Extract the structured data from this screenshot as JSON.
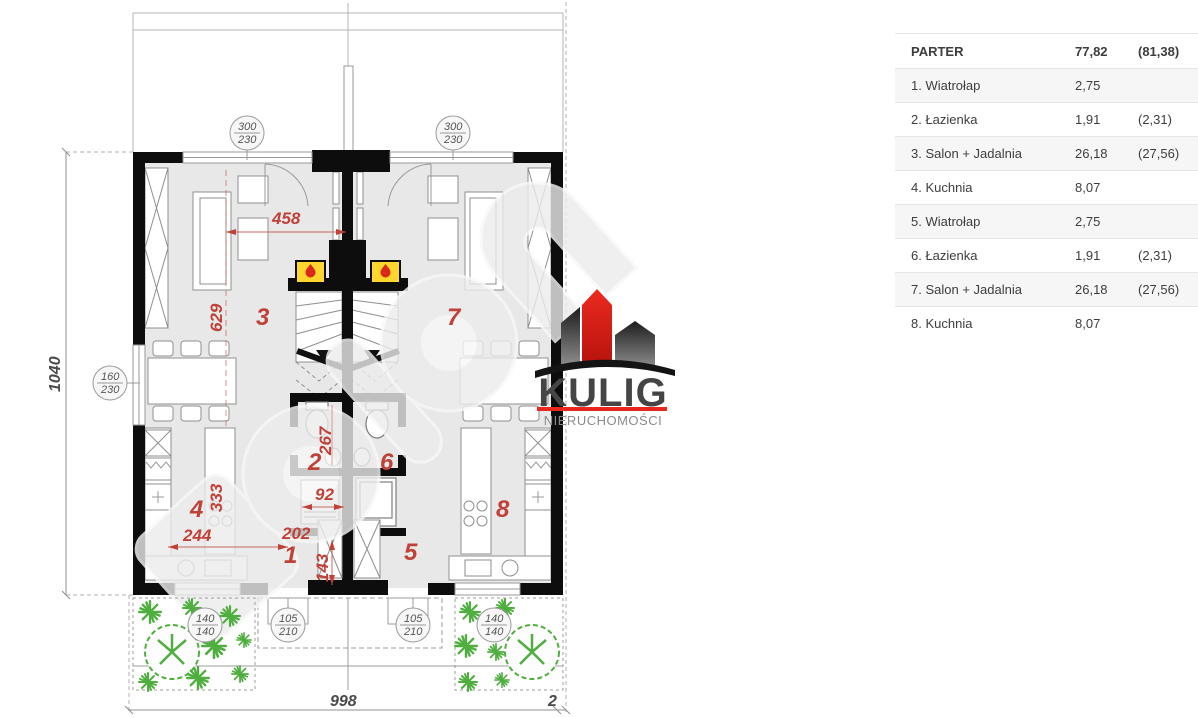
{
  "panel": {
    "header": {
      "label": "PARTER",
      "value": "77,82",
      "value_alt": "(81,38)"
    },
    "rows": [
      {
        "label": "1. Wiatrołap",
        "value": "2,75",
        "value_alt": ""
      },
      {
        "label": "2. Łazienka",
        "value": "1,91",
        "value_alt": "(2,31)"
      },
      {
        "label": "3. Salon + Jadalnia",
        "value": "26,18",
        "value_alt": "(27,56)"
      },
      {
        "label": "4. Kuchnia",
        "value": "8,07",
        "value_alt": ""
      },
      {
        "label": "5. Wiatrołap",
        "value": "2,75",
        "value_alt": ""
      },
      {
        "label": "6. Łazienka",
        "value": "1,91",
        "value_alt": "(2,31)"
      },
      {
        "label": "7. Salon + Jadalnia",
        "value": "26,18",
        "value_alt": "(27,56)"
      },
      {
        "label": "8. Kuchnia",
        "value": "8,07",
        "value_alt": ""
      }
    ]
  },
  "logo": {
    "brand": "KULIG",
    "subtitle": "NIERUCHOMOŚCI"
  },
  "plan": {
    "rooms": {
      "n1": "1",
      "n2": "2",
      "n3": "3",
      "n4": "4",
      "n5": "5",
      "n6": "6",
      "n7": "7",
      "n8": "8"
    },
    "dims": {
      "d458": "458",
      "d629": "629",
      "d267": "267",
      "d92": "92",
      "d202": "202",
      "d143": "143",
      "d333": "333",
      "d244": "244",
      "height_total": "1040",
      "width_total": "998",
      "width_right": "2"
    },
    "windows": {
      "w300_230": {
        "top": "300",
        "bottom": "230"
      },
      "w160_230": {
        "top": "160",
        "bottom": "230"
      },
      "w140_140": {
        "top": "140",
        "bottom": "140"
      },
      "w105_210": {
        "top": "105",
        "bottom": "210"
      }
    }
  },
  "colors": {
    "dimension_red": "#bf4138",
    "wall_black": "#0d0d0d",
    "room_fill": "#e8e8e8",
    "plant_green": "#4faf3e",
    "fireplace_yellow": "#ffd62e",
    "flame_red": "#d8291b",
    "logo_red": "#e8271e"
  }
}
